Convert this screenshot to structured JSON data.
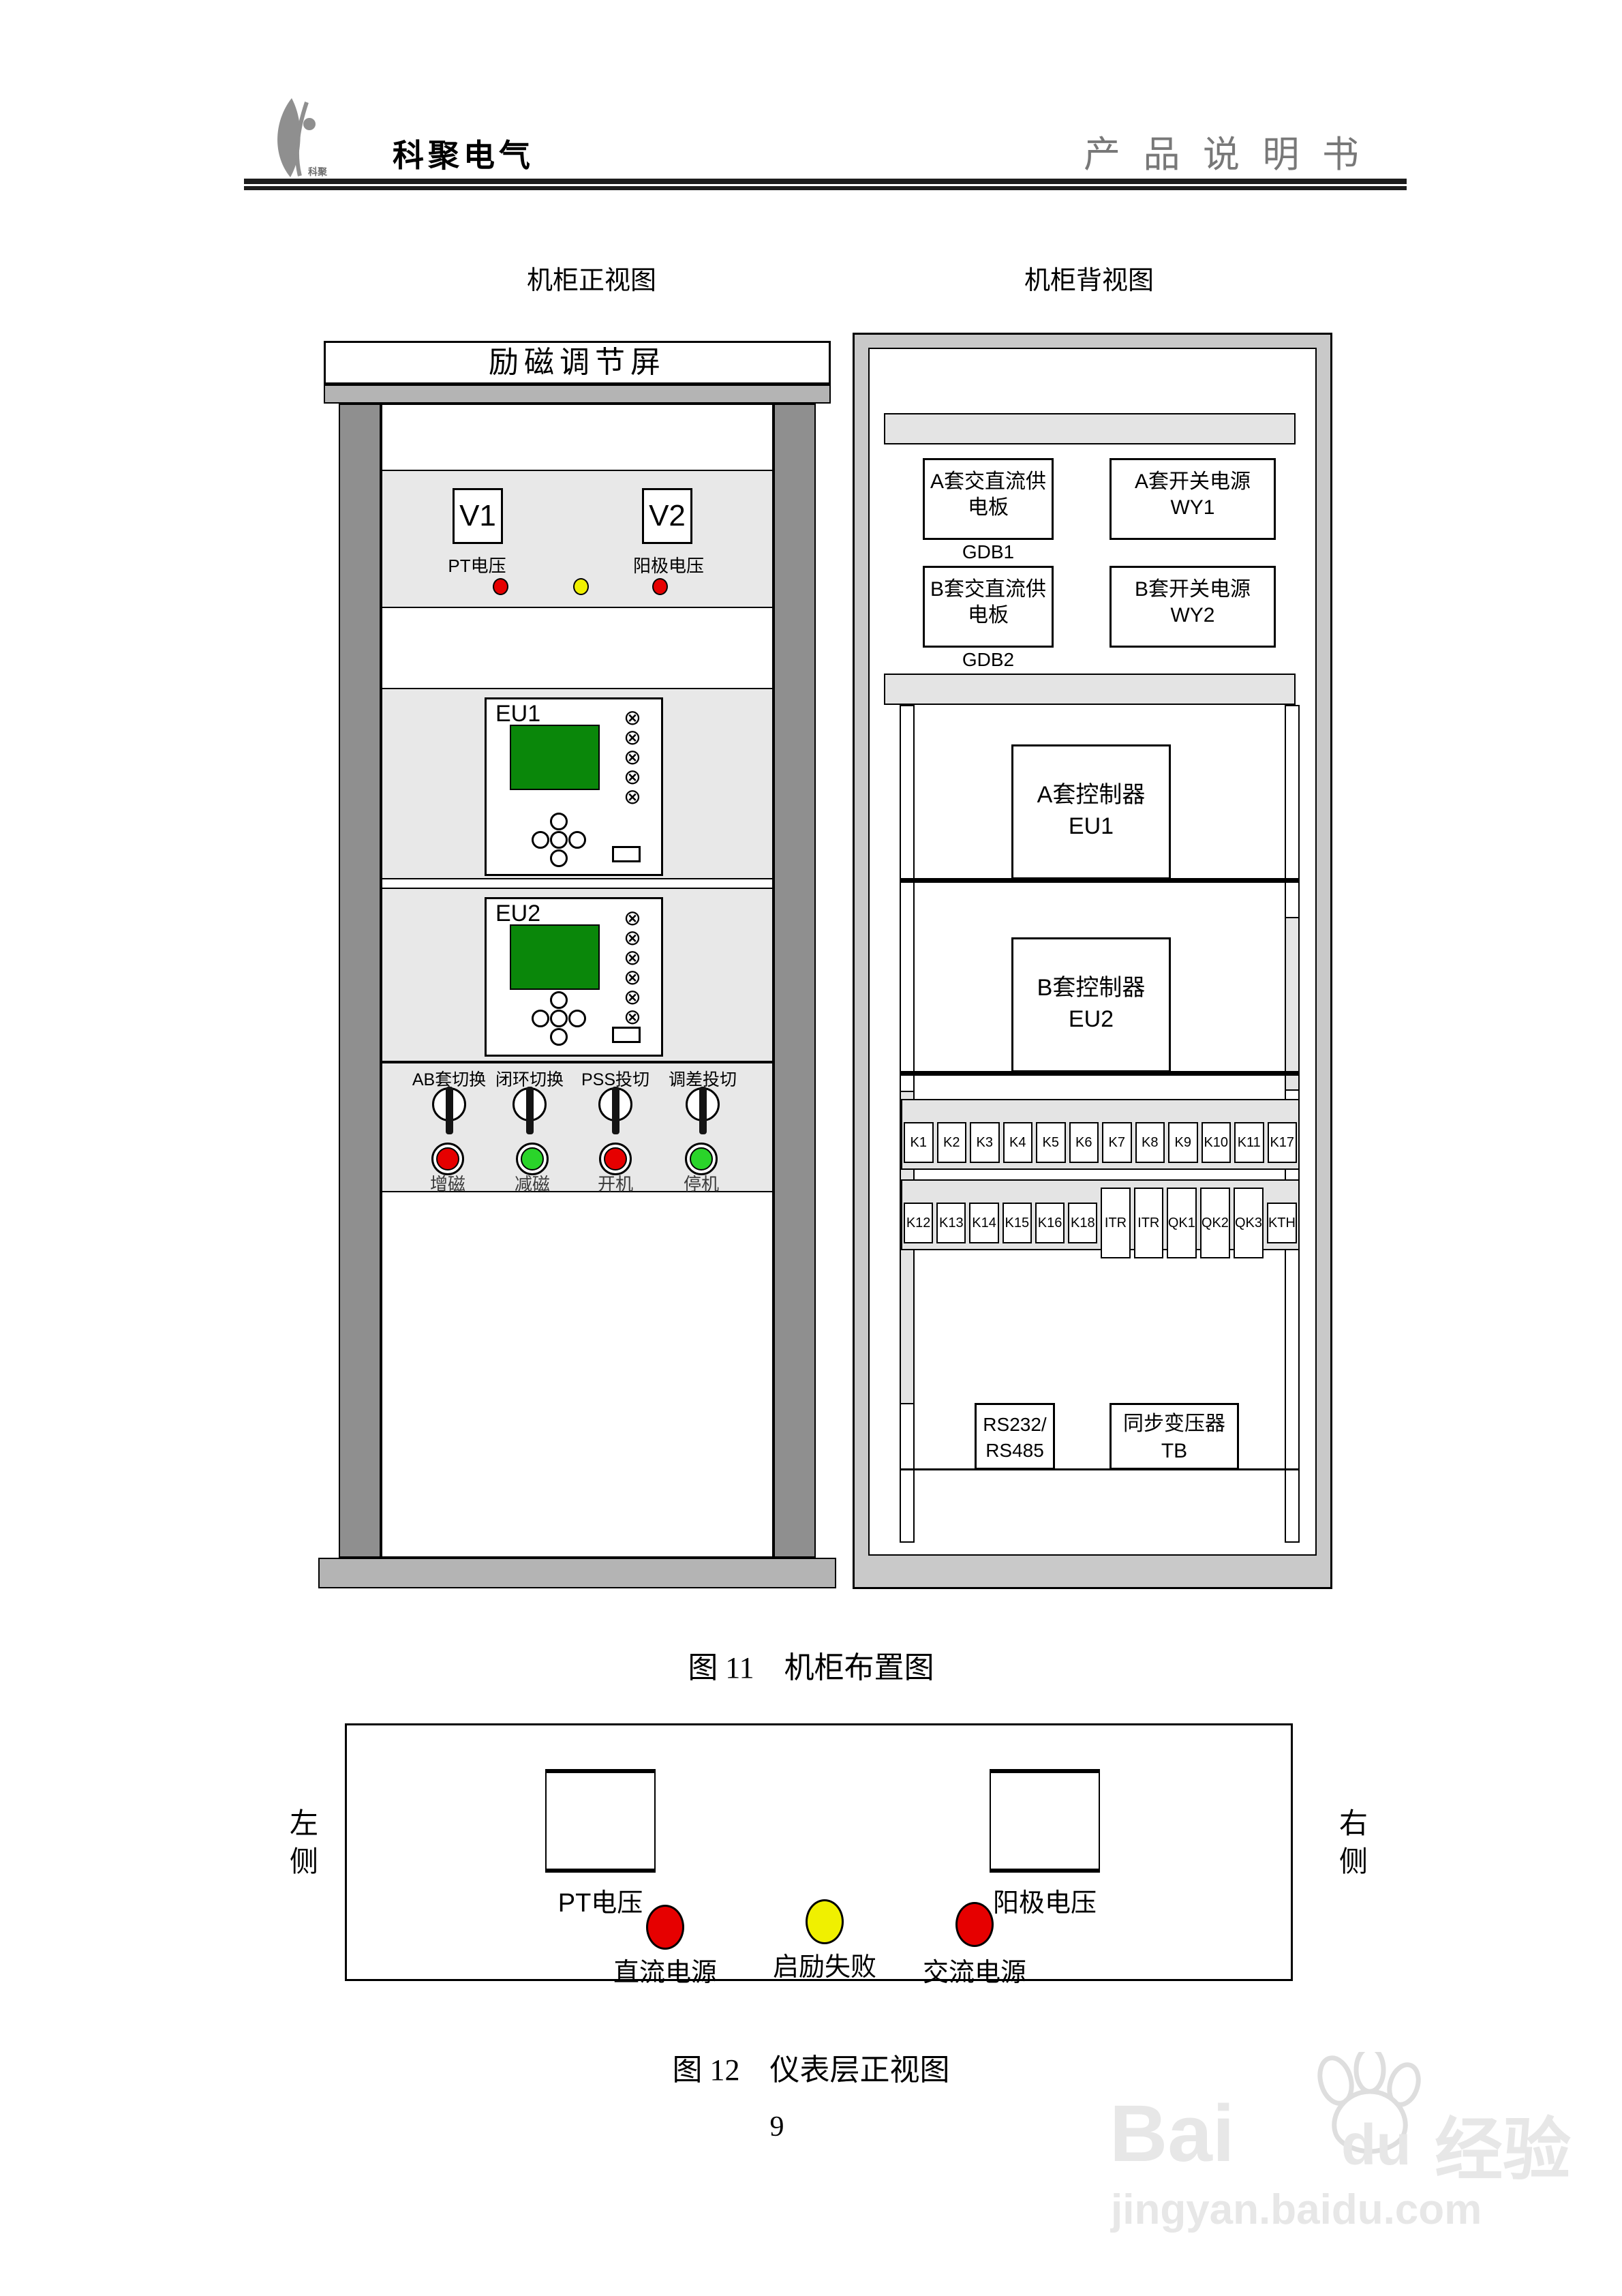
{
  "header": {
    "company": "科聚电气",
    "logo_text": "科聚",
    "doc_title": "产 品 说 明 书"
  },
  "figure11": {
    "caption": "图 11　机柜布置图",
    "front": {
      "view_title": "机柜正视图",
      "screen_title": "励磁调节屏",
      "meter1": "V1",
      "meter2": "V2",
      "meter1_label": "PT电压",
      "meter2_label": "阳极电压",
      "meter_lights": [
        "#e60000",
        "#f0f000",
        "#e60000"
      ],
      "eu1_label": "EU1",
      "eu2_label": "EU2",
      "switch_labels": [
        "AB套切换",
        "闭环切换",
        "PSS投切",
        "调差投切"
      ],
      "buttons": [
        {
          "label": "增磁",
          "color": "#e60000"
        },
        {
          "label": "减磁",
          "color": "#2ad42a"
        },
        {
          "label": "开机",
          "color": "#e60000"
        },
        {
          "label": "停机",
          "color": "#2ad42a"
        }
      ]
    },
    "back": {
      "view_title": "机柜背视图",
      "power_box1": {
        "line1": "A套交直流供",
        "line2": "电板",
        "code": "GDB1"
      },
      "power_box2": {
        "line1": "A套开关电源",
        "line2": "WY1"
      },
      "power_box3": {
        "line1": "B套交直流供",
        "line2": "电板",
        "code": "GDB2"
      },
      "power_box4": {
        "line1": "B套开关电源",
        "line2": "WY2"
      },
      "controller_a": {
        "line1": "A套控制器",
        "line2": "EU1"
      },
      "controller_b": {
        "line1": "B套控制器",
        "line2": "EU2"
      },
      "relay_row1": [
        "K1",
        "K2",
        "K3",
        "K4",
        "K5",
        "K6",
        "K7",
        "K8",
        "K9",
        "K10",
        "K11",
        "K17"
      ],
      "relay_row2": [
        "K12",
        "K13",
        "K14",
        "K15",
        "K16",
        "K18"
      ],
      "relay_row2_tall": [
        "ITR",
        "ITR",
        "QK1",
        "QK2",
        "QK3"
      ],
      "relay_row2_end": "KTH",
      "comm_box": {
        "line1": "RS232/",
        "line2": "RS485"
      },
      "tb_box": {
        "line1": "同步变压器",
        "line2": "TB"
      }
    }
  },
  "figure12": {
    "caption": "图 12　仪表层正视图",
    "left_side": "左侧",
    "right_side": "右侧",
    "meter1_label": "PT电压",
    "meter2_label": "阳极电压",
    "lights": [
      {
        "label": "直流电源",
        "color": "#e60000"
      },
      {
        "label": "启励失败",
        "color": "#f0f000"
      },
      {
        "label": "交流电源",
        "color": "#e60000"
      }
    ]
  },
  "page_number": "9",
  "watermark": {
    "brand_latin_1": "Bai",
    "brand_latin_2": "du",
    "brand_cn": "经验",
    "url": "jingyan.baidu.com"
  },
  "icons": {
    "lamp": "⊗"
  },
  "colors": {
    "screen_green": "#0a870a"
  }
}
